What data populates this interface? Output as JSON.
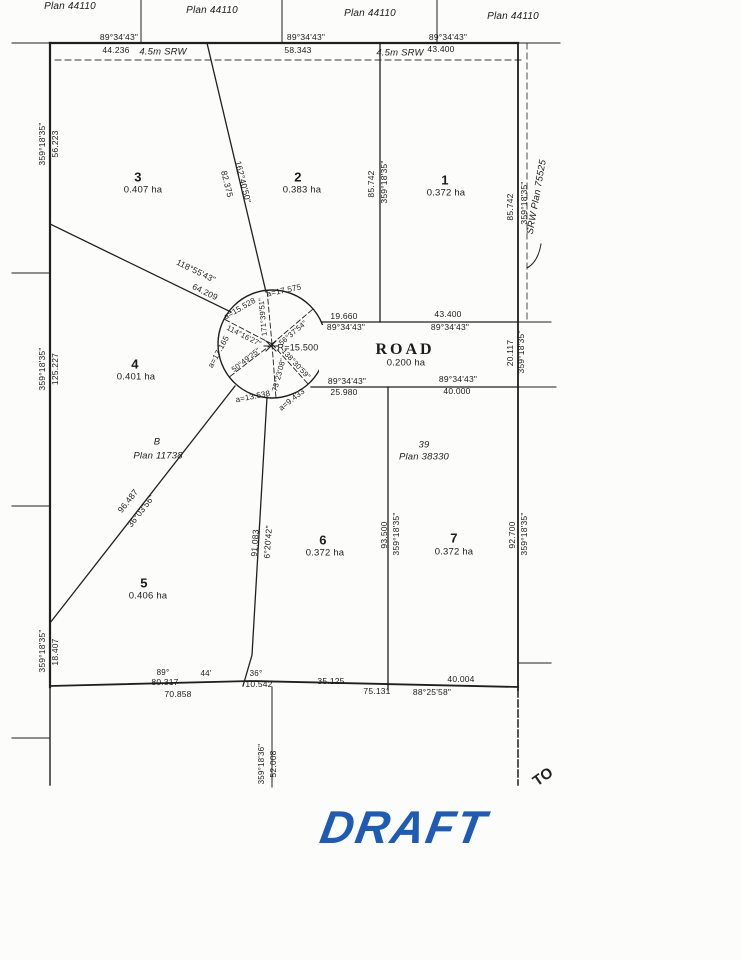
{
  "watermark": {
    "text": "DRAFT",
    "color": "#1d5bb6"
  },
  "annotations": {
    "handwritten_note": "TO"
  },
  "parcel_plan": {
    "adjacent_plans": [
      "Plan 44110",
      "Plan 44110",
      "Plan 44110",
      "Plan 44110"
    ],
    "reference_parcels": [
      {
        "lot": "B",
        "plan": "Plan 11738"
      },
      {
        "lot": "39",
        "plan": "Plan 38330"
      },
      {
        "plan": "SRW Plan 75525"
      }
    ],
    "lots": [
      {
        "number": "1",
        "area": "0.372 ha"
      },
      {
        "number": "2",
        "area": "0.383 ha"
      },
      {
        "number": "3",
        "area": "0.407 ha"
      },
      {
        "number": "4",
        "area": "0.401 ha"
      },
      {
        "number": "5",
        "area": "0.406 ha"
      },
      {
        "number": "6",
        "area": "0.372 ha"
      },
      {
        "number": "7",
        "area": "0.372 ha"
      }
    ],
    "road": {
      "name": "ROAD",
      "area": "0.200 ha"
    },
    "cul_de_sac_radius": "R=15.500"
  },
  "labels": [
    {
      "t": "Plan 44110",
      "x": 70,
      "y": 7,
      "s": 10,
      "c": "it",
      "n": "adjacent-plan-label"
    },
    {
      "t": "Plan 44110",
      "x": 212,
      "y": 11,
      "s": 10,
      "c": "it",
      "n": "adjacent-plan-label"
    },
    {
      "t": "Plan 44110",
      "x": 370,
      "y": 14,
      "s": 10,
      "c": "it",
      "n": "adjacent-plan-label"
    },
    {
      "t": "Plan 44110",
      "x": 513,
      "y": 17,
      "s": 10,
      "c": "it",
      "n": "adjacent-plan-label"
    },
    {
      "t": "89°34'43\"",
      "x": 119,
      "y": 37,
      "n": "bearing-label"
    },
    {
      "t": "44.236",
      "x": 116,
      "y": 50,
      "n": "distance-label"
    },
    {
      "t": "4.5m SRW",
      "x": 163,
      "y": 52,
      "s": 9.5,
      "c": "it",
      "n": "srw-label"
    },
    {
      "t": "89°34'43\"",
      "x": 306,
      "y": 37,
      "n": "bearing-label"
    },
    {
      "t": "58.343",
      "x": 298,
      "y": 50,
      "n": "distance-label"
    },
    {
      "t": "4.5m SRW",
      "x": 400,
      "y": 53,
      "s": 9.5,
      "c": "it",
      "n": "srw-label"
    },
    {
      "t": "43.400",
      "x": 441,
      "y": 49,
      "n": "distance-label"
    },
    {
      "t": "89°34'43\"",
      "x": 448,
      "y": 37,
      "n": "bearing-label"
    },
    {
      "t": "359°18'35\"",
      "x": 42,
      "y": 144,
      "r": -90,
      "n": "bearing-label"
    },
    {
      "t": "56.223",
      "x": 55,
      "y": 144,
      "r": -90,
      "n": "distance-label"
    },
    {
      "t": "359°18'35\"",
      "x": 42,
      "y": 369,
      "r": -90,
      "n": "bearing-label"
    },
    {
      "t": "125.227",
      "x": 55,
      "y": 369,
      "r": -90,
      "n": "distance-label"
    },
    {
      "t": "359°18'35\"",
      "x": 42,
      "y": 651,
      "r": -90,
      "n": "bearing-label"
    },
    {
      "t": "18.407",
      "x": 55,
      "y": 652,
      "r": -90,
      "n": "distance-label"
    },
    {
      "t": "85.742",
      "x": 371,
      "y": 184,
      "r": -90,
      "n": "distance-label"
    },
    {
      "t": "359°18'35\"",
      "x": 384,
      "y": 182,
      "r": -90,
      "n": "bearing-label"
    },
    {
      "t": "85.742",
      "x": 510,
      "y": 207,
      "r": -90,
      "n": "distance-label"
    },
    {
      "t": "359°18'35\"",
      "x": 524,
      "y": 203,
      "r": -90,
      "n": "bearing-label"
    },
    {
      "t": "SRW Plan 75525",
      "x": 537,
      "y": 197,
      "r": -80,
      "s": 9.5,
      "c": "it",
      "n": "srw-plan-label"
    },
    {
      "t": "3",
      "x": 138,
      "y": 177,
      "s": 13,
      "c": "b",
      "n": "lot-number"
    },
    {
      "t": "0.407 ha",
      "x": 143,
      "y": 190,
      "s": 9.5,
      "n": "lot-area"
    },
    {
      "t": "2",
      "x": 298,
      "y": 177,
      "s": 13,
      "c": "b",
      "n": "lot-number"
    },
    {
      "t": "0.383 ha",
      "x": 302,
      "y": 190,
      "s": 9.5,
      "n": "lot-area"
    },
    {
      "t": "1",
      "x": 445,
      "y": 180,
      "s": 13,
      "c": "b",
      "n": "lot-number"
    },
    {
      "t": "0.372 ha",
      "x": 446,
      "y": 193,
      "s": 9.5,
      "n": "lot-area"
    },
    {
      "t": "4",
      "x": 135,
      "y": 364,
      "s": 13,
      "c": "b",
      "n": "lot-number"
    },
    {
      "t": "0.401 ha",
      "x": 136,
      "y": 377,
      "s": 9.5,
      "n": "lot-area"
    },
    {
      "t": "5",
      "x": 144,
      "y": 583,
      "s": 13,
      "c": "b",
      "n": "lot-number"
    },
    {
      "t": "0.406 ha",
      "x": 148,
      "y": 596,
      "s": 9.5,
      "n": "lot-area"
    },
    {
      "t": "6",
      "x": 323,
      "y": 540,
      "s": 13,
      "c": "b",
      "n": "lot-number"
    },
    {
      "t": "0.372 ha",
      "x": 325,
      "y": 553,
      "s": 9.5,
      "n": "lot-area"
    },
    {
      "t": "7",
      "x": 454,
      "y": 538,
      "s": 13,
      "c": "b",
      "n": "lot-number"
    },
    {
      "t": "0.372 ha",
      "x": 454,
      "y": 552,
      "s": 9.5,
      "n": "lot-area"
    },
    {
      "t": "ROAD",
      "x": 405,
      "y": 350,
      "s": 16,
      "c": "serif",
      "n": "road-name"
    },
    {
      "t": "0.200 ha",
      "x": 406,
      "y": 363,
      "s": 9.5,
      "n": "road-area"
    },
    {
      "t": "B",
      "x": 157,
      "y": 442,
      "s": 9.5,
      "c": "it",
      "n": "plan-ref-label"
    },
    {
      "t": "Plan 11738",
      "x": 158,
      "y": 456,
      "s": 9.5,
      "c": "it",
      "n": "plan-ref-label"
    },
    {
      "t": "39",
      "x": 424,
      "y": 445,
      "s": 9.5,
      "c": "it",
      "n": "plan-ref-label"
    },
    {
      "t": "Plan 38330",
      "x": 424,
      "y": 457,
      "s": 9.5,
      "c": "it",
      "n": "plan-ref-label"
    },
    {
      "t": "162°40'50\"",
      "x": 243,
      "y": 182,
      "r": 76,
      "n": "bearing-label"
    },
    {
      "t": "82.375",
      "x": 227,
      "y": 184,
      "r": 76,
      "n": "distance-label"
    },
    {
      "t": "118°55'43\"",
      "x": 196,
      "y": 271,
      "r": 26,
      "n": "bearing-label"
    },
    {
      "t": "64.209",
      "x": 205,
      "y": 292,
      "r": 26,
      "n": "distance-label"
    },
    {
      "t": "96.487",
      "x": 128,
      "y": 501,
      "r": -52,
      "n": "distance-label"
    },
    {
      "t": "36°03'56\"",
      "x": 141,
      "y": 511,
      "r": -52,
      "n": "bearing-label"
    },
    {
      "t": "91.083",
      "x": 255,
      "y": 543,
      "r": -86,
      "n": "distance-label"
    },
    {
      "t": "6°20'42\"",
      "x": 268,
      "y": 542,
      "r": -86,
      "n": "bearing-label"
    },
    {
      "t": "93.500",
      "x": 384,
      "y": 535,
      "r": -90,
      "n": "distance-label"
    },
    {
      "t": "359°18'35\"",
      "x": 396,
      "y": 534,
      "r": -90,
      "n": "bearing-label"
    },
    {
      "t": "92.700",
      "x": 512,
      "y": 535,
      "r": -90,
      "n": "distance-label"
    },
    {
      "t": "359°18'35\"",
      "x": 524,
      "y": 534,
      "r": -90,
      "n": "bearing-label"
    },
    {
      "t": "19.660",
      "x": 344,
      "y": 316,
      "n": "distance-label"
    },
    {
      "t": "89°34'43\"",
      "x": 346,
      "y": 327,
      "n": "bearing-label"
    },
    {
      "t": "43.400",
      "x": 448,
      "y": 314,
      "n": "distance-label"
    },
    {
      "t": "89°34'43\"",
      "x": 450,
      "y": 327,
      "n": "bearing-label"
    },
    {
      "t": "89°34'43\"",
      "x": 347,
      "y": 381,
      "n": "bearing-label"
    },
    {
      "t": "25.980",
      "x": 344,
      "y": 392,
      "n": "distance-label"
    },
    {
      "t": "89°34'43\"",
      "x": 458,
      "y": 379,
      "n": "bearing-label"
    },
    {
      "t": "40.000",
      "x": 457,
      "y": 391,
      "n": "distance-label"
    },
    {
      "t": "20.117",
      "x": 510,
      "y": 353,
      "r": -90,
      "n": "distance-label"
    },
    {
      "t": "359°18'35\"",
      "x": 521,
      "y": 352,
      "r": -90,
      "n": "bearing-label"
    },
    {
      "t": "a=17.575",
      "x": 284,
      "y": 291,
      "r": -12,
      "s": 8,
      "n": "arc-length-label"
    },
    {
      "t": "a=15.528",
      "x": 240,
      "y": 309,
      "r": -30,
      "s": 8,
      "n": "arc-length-label"
    },
    {
      "t": "a=17.165",
      "x": 219,
      "y": 352,
      "r": -61,
      "s": 8,
      "n": "arc-length-label"
    },
    {
      "t": "a=13.538",
      "x": 253,
      "y": 397,
      "r": -11,
      "s": 8,
      "n": "arc-length-label"
    },
    {
      "t": "a=9.433",
      "x": 292,
      "y": 400,
      "r": -38,
      "s": 8,
      "n": "arc-length-label"
    },
    {
      "t": "R=15.500",
      "x": 298,
      "y": 348,
      "s": 9,
      "n": "radius-label"
    },
    {
      "t": "171°39'51\"",
      "x": 263,
      "y": 317,
      "r": -95,
      "s": 7.5,
      "n": "radial-bearing-label"
    },
    {
      "t": "56°37'54\"",
      "x": 293,
      "y": 333,
      "r": -40,
      "s": 7.5,
      "n": "radial-bearing-label"
    },
    {
      "t": "114°16'27\"",
      "x": 244,
      "y": 336,
      "r": 27,
      "s": 7.5,
      "n": "radial-bearing-label"
    },
    {
      "t": "50°49'25\"",
      "x": 246,
      "y": 360,
      "r": -38,
      "s": 7.5,
      "n": "radial-bearing-label"
    },
    {
      "t": "73°23'08\"",
      "x": 279,
      "y": 375,
      "r": -75,
      "s": 7.5,
      "n": "radial-bearing-label"
    },
    {
      "t": "138°30'59\"",
      "x": 296,
      "y": 364,
      "r": 47,
      "s": 7.5,
      "n": "radial-bearing-label"
    },
    {
      "t": "89°",
      "x": 163,
      "y": 673,
      "s": 8,
      "n": "bearing-label"
    },
    {
      "t": "80.317",
      "x": 165,
      "y": 682,
      "n": "distance-label"
    },
    {
      "t": "44'",
      "x": 206,
      "y": 674,
      "s": 8,
      "n": "bearing-label"
    },
    {
      "t": "36°",
      "x": 256,
      "y": 674,
      "s": 8,
      "n": "bearing-label"
    },
    {
      "t": "10.542",
      "x": 259,
      "y": 684,
      "n": "distance-label"
    },
    {
      "t": "70.858",
      "x": 178,
      "y": 694,
      "n": "distance-label"
    },
    {
      "t": "35.125",
      "x": 331,
      "y": 681,
      "n": "distance-label"
    },
    {
      "t": "75.131",
      "x": 377,
      "y": 691,
      "n": "distance-label"
    },
    {
      "t": "88°25'58\"",
      "x": 432,
      "y": 692,
      "n": "bearing-label"
    },
    {
      "t": "40.004",
      "x": 461,
      "y": 679,
      "n": "distance-label"
    },
    {
      "t": "359°18'36\"",
      "x": 262,
      "y": 764,
      "r": -90,
      "s": 8,
      "n": "bearing-label"
    },
    {
      "t": "52.008",
      "x": 273,
      "y": 764,
      "r": -90,
      "n": "distance-label"
    }
  ]
}
